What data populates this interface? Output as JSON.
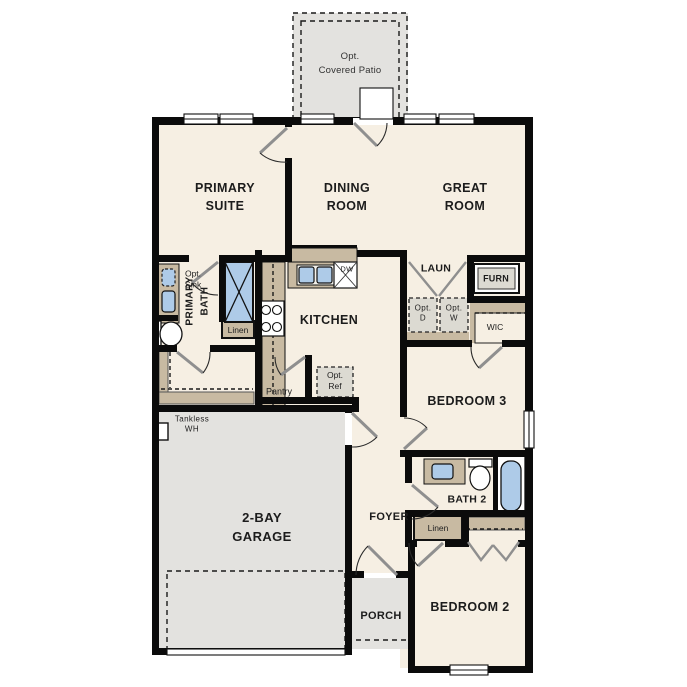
{
  "colors": {
    "wall": "#0b0b0b",
    "room_fill": "#f6efe3",
    "concrete_fill": "#e3e2df",
    "counter_fill": "#c8baa2",
    "fixture_blue": "#aecbe8",
    "optional_fill": "#dcdad2"
  },
  "labels": {
    "patio": {
      "l1": "Opt.",
      "l2": "Covered Patio"
    },
    "primary_suite": {
      "l1": "PRIMARY",
      "l2": "SUITE"
    },
    "dining_room": {
      "l1": "DINING",
      "l2": "ROOM"
    },
    "great_room": {
      "l1": "GREAT",
      "l2": "ROOM"
    },
    "kitchen": "KITCHEN",
    "laundry": "LAUN",
    "furnace": "FURN",
    "opt_dryer": {
      "l1": "Opt.",
      "l2": "D"
    },
    "opt_washer": {
      "l1": "Opt.",
      "l2": "W"
    },
    "wic_right": "WIC",
    "wic_left": "WIC",
    "bedroom3": "BEDROOM 3",
    "bath2": "BATH 2",
    "linen_bath2": "Linen",
    "linen_primary": "Linen",
    "primary_bath": {
      "l1": "PRIMARY",
      "l2": "BATH"
    },
    "opt_sink": {
      "l1": "Opt.",
      "l2": "Sink"
    },
    "pantry": "Pantry",
    "opt_ref": {
      "l1": "Opt.",
      "l2": "Ref"
    },
    "tankless": {
      "l1": "Tankless",
      "l2": "WH"
    },
    "garage": {
      "l1": "2-BAY",
      "l2": "GARAGE"
    },
    "foyer": "FOYER",
    "porch": "PORCH",
    "bedroom2": "BEDROOM 2",
    "dishwasher": "DW"
  }
}
